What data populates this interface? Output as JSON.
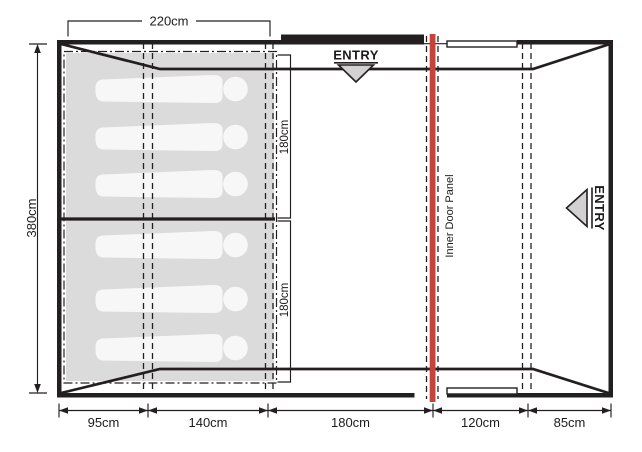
{
  "dims": {
    "top": "220cm",
    "left": "380cm",
    "inner_top": "180cm",
    "inner_bottom": "180cm",
    "bottom": [
      "95cm",
      "140cm",
      "180cm",
      "120cm",
      "85cm"
    ]
  },
  "labels": {
    "entry_top": "ENTRY",
    "entry_side": "ENTRY",
    "inner_door_panel": "Inner Door Panel"
  },
  "colors": {
    "outline": "#231f20",
    "bedroom_fill": "#dbdbdb",
    "silhouette_fill": "#f7f7f7",
    "door_panel_red": "#c5433a",
    "entry_arrow_fill": "#d2d2d2"
  },
  "sleeping": {
    "capacity": 6
  }
}
